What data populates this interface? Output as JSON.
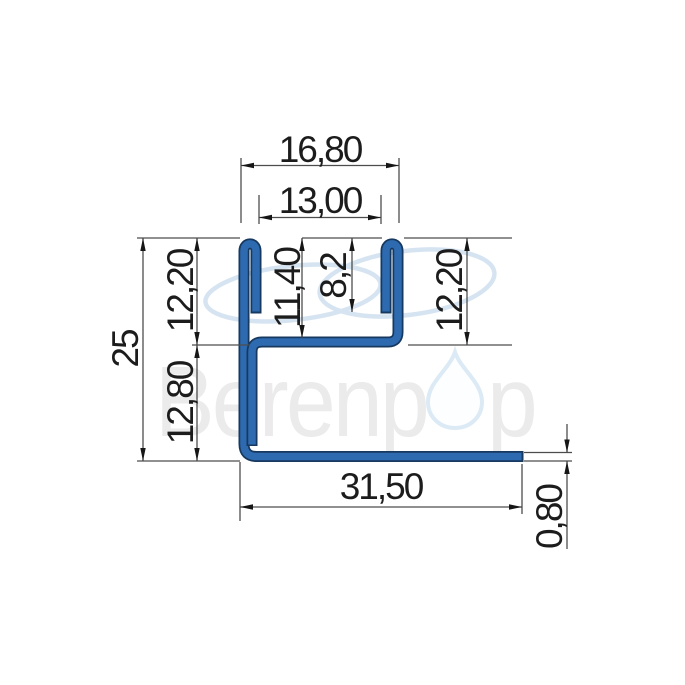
{
  "drawing": {
    "dimensions": {
      "top_outer_width": "16,80",
      "top_inner_width": "13,00",
      "slot_depth_to_web_top": "11,40",
      "lip_depth": "8,2",
      "right_upper_height": "12,20",
      "total_height": "25",
      "left_upper_height": "12,20",
      "left_lower_height": "12,80",
      "bottom_flange_width": "31,50",
      "material_thickness": "0,80"
    },
    "colors": {
      "profile_fill": "#2e6ab0",
      "profile_outline": "#17395f",
      "dimension_line": "#4d4d4d",
      "arrow_color": "#161616",
      "dim_text_color": "#1c1c1c",
      "watermark_text": "#ebebeb",
      "watermark_ellipse": "#d6e4f2",
      "watermark_drop_stroke": "#dceaf5",
      "watermark_drop_fill": "#fdfeff"
    },
    "watermark": {
      "brand_prefix": "Berenp",
      "brand_suffix": "p"
    }
  }
}
